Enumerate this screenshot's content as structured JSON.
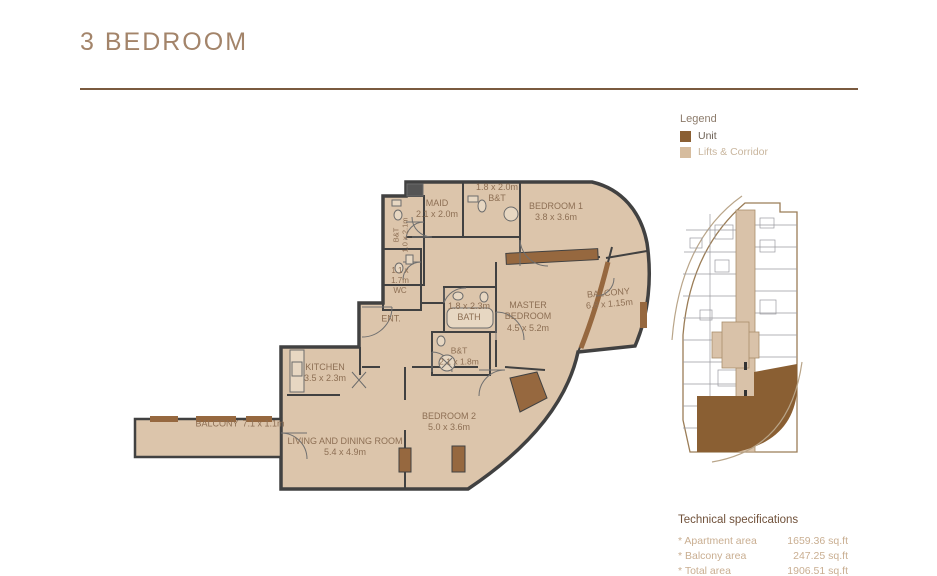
{
  "page": {
    "title": "3 BEDROOM"
  },
  "legend": {
    "title": "Legend",
    "items": [
      {
        "label": "Unit",
        "color": "#8a5f33"
      },
      {
        "label": "Lifts & Corridor",
        "color": "#d6bc9e"
      }
    ]
  },
  "plan": {
    "rooms": [
      {
        "name": "MAID",
        "dims": "2.1 x 2.0m"
      },
      {
        "name": "B&T",
        "dims": "1.8 x 2.0m"
      },
      {
        "name": "BEDROOM 1",
        "dims": "3.8 x 3.6m"
      },
      {
        "name": "B&T",
        "dims": "1.0 x 2.1m"
      },
      {
        "name": "WC",
        "dims": "1.1 x 1.7m"
      },
      {
        "name": "ENT."
      },
      {
        "name": "BATH",
        "dims": "1.8 x 2.3m"
      },
      {
        "name": "B&T",
        "dims": "2.1 x 1.8m"
      },
      {
        "name": "KITCHEN",
        "dims": "3.5 x 2.3m"
      },
      {
        "name": "MASTER BEDROOM",
        "dims": "4.5 x 5.2m"
      },
      {
        "name": "BALCONY",
        "dims": "6.8 x 1.15m"
      },
      {
        "name": "BEDROOM 2",
        "dims": "5.0 x 3.6m"
      },
      {
        "name": "LIVING AND DINING ROOM",
        "dims": "5.4 x 4.9m"
      },
      {
        "name": "BALCONY",
        "dims": "7.1 x 1.1m"
      }
    ]
  },
  "colors": {
    "unit": "#8a5f33",
    "lifts_corridor": "#d6bc9e",
    "floor": "#dcc5ab",
    "accent": "#96683f",
    "title": "#a3846a"
  },
  "tech_specs": {
    "title": "Technical specifications",
    "rows": [
      {
        "label": "* Apartment area",
        "value": "1659.36 sq.ft"
      },
      {
        "label": "* Balcony area",
        "value": "247.25 sq.ft"
      },
      {
        "label": "* Total area",
        "value": "1906.51 sq.ft"
      }
    ]
  }
}
